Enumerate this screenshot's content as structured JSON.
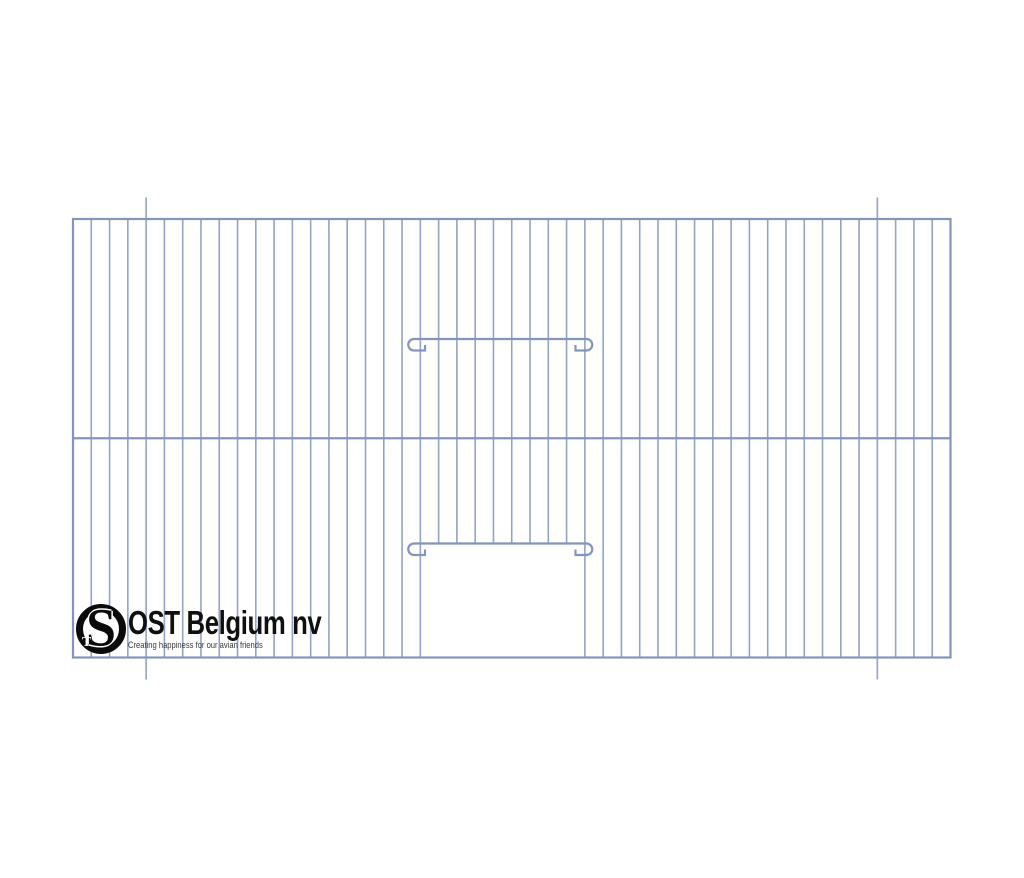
{
  "page": {
    "width": 1024,
    "height": 878,
    "background": "#ffffff"
  },
  "logo": {
    "brand": "OST Belgium nv",
    "tagline": "Creating happiness for our avian friends",
    "monogram": {
      "s": "S",
      "t": "T"
    },
    "ink_color": "#101010",
    "tagline_color": "#3a3a3a"
  },
  "diagram": {
    "type": "technical-line-drawing",
    "subject": "bird cage front panel with sliding door and bend marks",
    "colors": {
      "frame": "#8495bb",
      "wire": "#94a3c4"
    },
    "stroke_width": {
      "frame": 2.2,
      "wire": 1.6,
      "bar": 2.2
    },
    "frame": {
      "x": 73,
      "y": 219,
      "width": 877.5,
      "height": 438.5
    },
    "mid_rail_y": 438.25,
    "wires": {
      "count": 47,
      "start_x": 73,
      "spacing": 18.281,
      "top": 219,
      "bottom": 657.5
    },
    "door": {
      "removed_wires_from": 20,
      "removed_wires_to": 27,
      "top_bar_y": 339,
      "bottom_bar_y": 543.5,
      "bar_x1": 414,
      "bar_x2": 586.5,
      "hook_radius": 5.75,
      "hook_tab_length": 11,
      "hook_tick_height": 6
    },
    "bend_marks": {
      "wire_indices": [
        4,
        44
      ],
      "extend_top": 21.5,
      "extend_bottom": 22
    }
  }
}
